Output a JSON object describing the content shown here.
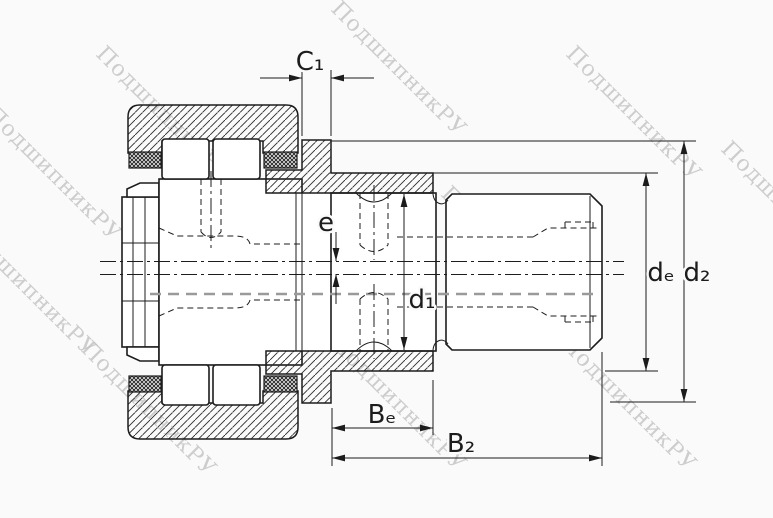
{
  "drawing": {
    "type": "bearing-cross-section",
    "description": "stud-type cam follower track roller, sectional technical drawing",
    "labels": {
      "c1": "C₁",
      "e": "e",
      "d1": "d₁",
      "de": "dₑ",
      "d2": "d₂",
      "be": "Bₑ",
      "b2": "B₂"
    }
  },
  "watermark": {
    "text": "ПодшипникРУ",
    "color": "#c2c2c2"
  },
  "colors": {
    "line": "#1c1c1c",
    "hidden_gray": "#9a9a9a",
    "background": "#fbfafb"
  }
}
